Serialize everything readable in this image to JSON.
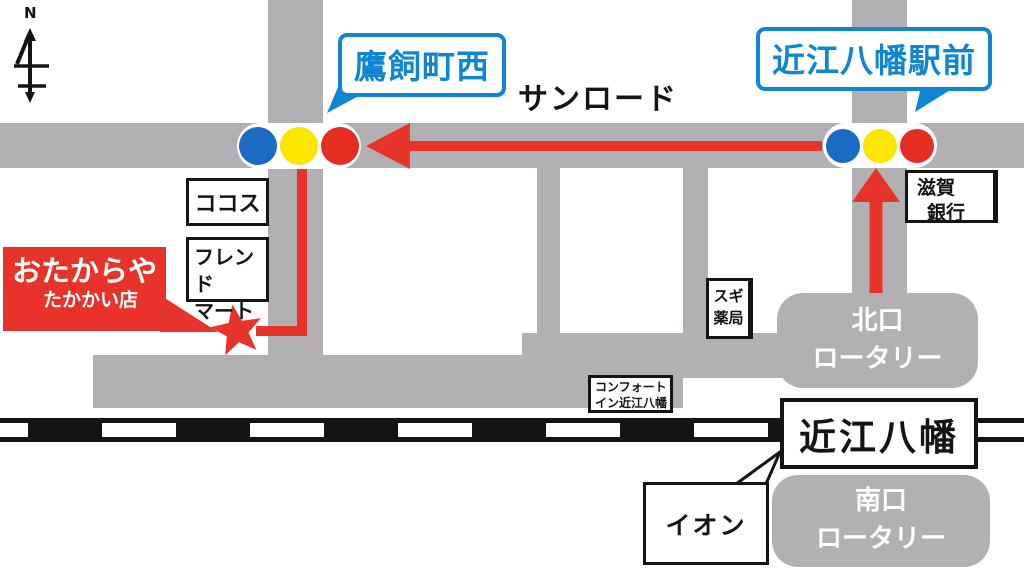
{
  "compass": {
    "north": "N"
  },
  "road_name": "サンロード",
  "bubbles": {
    "west": "鷹飼町西",
    "east": "近江八幡駅前"
  },
  "store_sign": {
    "name": "おたからや",
    "branch": "たかかい店"
  },
  "buildings": {
    "cocos": "ココス",
    "friend_mart": [
      "フレンド",
      "マート"
    ],
    "shiga_bank": [
      "滋賀",
      "銀行"
    ],
    "sugi_pharmacy": [
      "スギ",
      "薬局"
    ],
    "comfort_inn": [
      "コンフォート",
      "イン近江八幡"
    ],
    "aeon": "イオン"
  },
  "station": {
    "name": "近江八幡"
  },
  "rotaries": {
    "north": [
      "北口",
      "ロータリー"
    ],
    "south": [
      "南口",
      "ロータリー"
    ]
  },
  "colors": {
    "road_gray": "#b2b0b3",
    "route_red": "#e8332a",
    "bubble_blue": "#0f86d4",
    "signal_blue": "#1b6bc2",
    "signal_yellow": "#ffe400",
    "signal_red": "#e62d24",
    "rail_black": "#141414"
  }
}
